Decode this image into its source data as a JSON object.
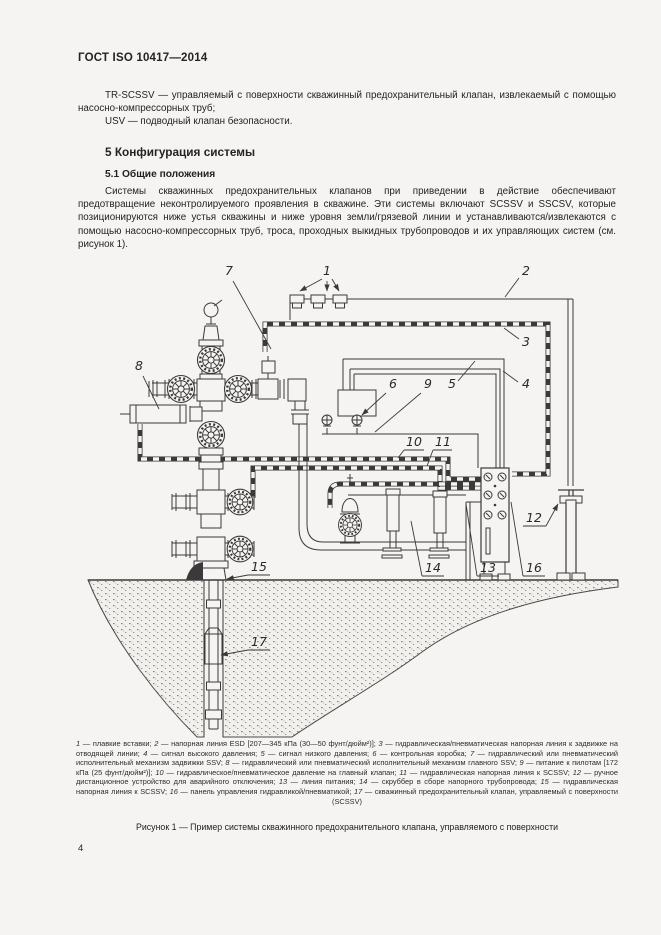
{
  "page": {
    "header": "ГОСТ ISO 10417—2014",
    "page_number": "4"
  },
  "intro": {
    "line1": "TR-SCSSV — управляемый с поверхности скважинный предохранительный клапан, извлекаемый с помощью насосно-компрессорных труб;",
    "line2": "USV — подводный клапан безопасности."
  },
  "section": {
    "title": "5  Конфигурация системы",
    "subtitle": "5.1  Общие положения",
    "body": "Системы скважинных предохранительных клапанов при приведении в действие обеспечивают предотвращение неконтролируемого проявления в скважине. Эти системы включают SCSSV и SSCSV, которые позиционируются ниже устья скважины и ниже уровня земли/грязевой линии и устанавливаются/извлекаются с помощью насосно-компрессорных труб, троса, проходных выкидных трубопроводов и их управляющих систем (см. рисунок 1)."
  },
  "figure": {
    "caption": "Рисунок 1 — Пример системы скважинного предохранительного клапана, управляемого с поверхности",
    "callout_labels": [
      "1",
      "2",
      "3",
      "4",
      "5",
      "6",
      "7",
      "8",
      "9",
      "10",
      "11",
      "12",
      "13",
      "14",
      "15",
      "16",
      "17"
    ],
    "legend_items": [
      {
        "num": "1",
        "text": "плавкие вставки"
      },
      {
        "num": "2",
        "text": "напорная линия ESD [207—345 кПа (30—50 фунт/дюйм²)]"
      },
      {
        "num": "3",
        "text": "гидравлическая/пневматическая напорная линия к задвижке на отводящей линии"
      },
      {
        "num": "4",
        "text": "сигнал высокого давления"
      },
      {
        "num": "5",
        "text": "сигнал низкого давления"
      },
      {
        "num": "6",
        "text": "контрольная коробка"
      },
      {
        "num": "7",
        "text": "гидравлический или пневматический исполнительный механизм задвижки SSV"
      },
      {
        "num": "8",
        "text": "гидравлический или пневматический исполнительный механизм главного SSV"
      },
      {
        "num": "9",
        "text": "питание к пилотам [172 кПа (25 фунт/дюйм²)]"
      },
      {
        "num": "10",
        "text": "гидравлическое/пневматическое давление на главный клапан"
      },
      {
        "num": "11",
        "text": "гидравлическая напорная линия к SCSSV"
      },
      {
        "num": "12",
        "text": "ручное дистанционное устройство для аварийного отключения"
      },
      {
        "num": "13",
        "text": "линия питания"
      },
      {
        "num": "14",
        "text": "скруббер в сборе напорного трубопровода"
      },
      {
        "num": "15",
        "text": "гидравлическая напорная линия к SCSSV"
      },
      {
        "num": "16",
        "text": "панель управления гидравликой/пневматикой"
      },
      {
        "num": "17",
        "text": "скважинный предохранительный клапан, управляемый с поверхности (SCSSV)"
      }
    ]
  },
  "colors": {
    "line": "#3a3a3a",
    "text": "#232323",
    "page_bg": "#f5f4f2"
  }
}
